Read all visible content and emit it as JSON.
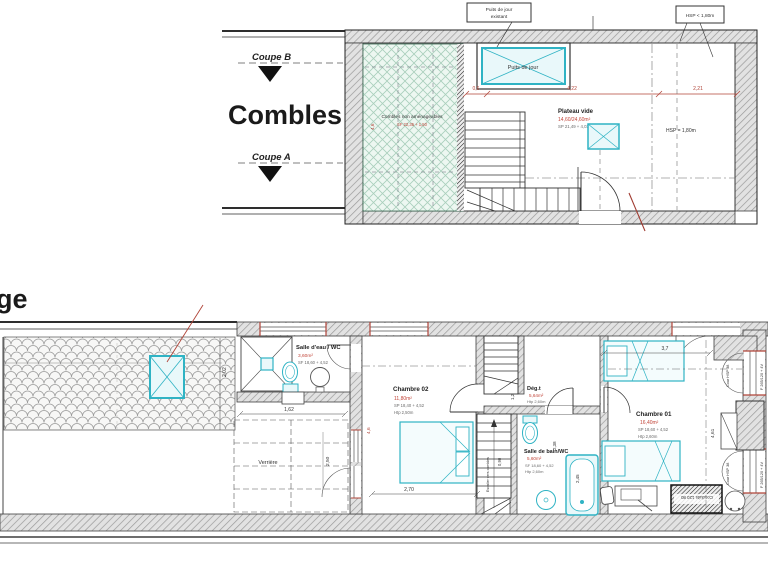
{
  "attic": {
    "title": "Combles",
    "coupe_b": "Coupe B",
    "coupe_a": "Coupe A",
    "unfinished_name": "Combles non aménageables",
    "unfinished_sub": "SF 22,35 + 1,50",
    "skylight_tag_line1": "Puits de jour",
    "skylight_tag_line2": "existant",
    "skylight_name": "Puits de jour",
    "hsp_tag": "HSP < 1,80m",
    "plateau_name": "Plateau vide",
    "plateau_area": "14,60/24,60m²",
    "plateau_sub": "SP 21,49 + 4,03",
    "hsp_mid": "HSP = 1,80m",
    "dim_a": "0,6",
    "dim_b": "4,22",
    "dim_c": "2,21",
    "dim_d": "4,6"
  },
  "floor": {
    "title_partial": "ge",
    "dim_roof": "2,02",
    "salle_eau_name": "Salle d'eau / WC",
    "salle_eau_area": "3,60m²",
    "salle_eau_sub": "SF 18,60 + 4,52",
    "dim_162": "1,62",
    "verriere": "Verrière",
    "dim_250": "2,50",
    "chambre02_name": "Chambre 02",
    "chambre02_area": "11,80m²",
    "chambre02_sub1": "SP 18,40 + 4,52",
    "chambre02_sub2": "Htp 2,50m",
    "dim_270": "2,70",
    "dim_46": "4,6",
    "stair_label": "Escalier vers combles",
    "stair_width": "0,90",
    "deg_name": "Dég.t",
    "deg_area": "5,64m²",
    "deg_sub": "Htp 2,60m",
    "dim_12": "1,2",
    "dim_238": "2,38",
    "sdb_name": "Salle de bain/WC",
    "sdb_area": "5,60m²",
    "sdb_sub1": "SF 18,60 + 4,52",
    "sdb_sub2": "Htp 2,60m",
    "dim_245": "2,45",
    "chambre01_name": "Chambre 01",
    "chambre01_area": "16,40m²",
    "chambre01_sub1": "SP 18,60 + 4,52",
    "chambre01_sub2": "Htp 2,60m",
    "dim_37": "3,7",
    "dim_461": "4,61",
    "window_court_1": "Cour HSP 38",
    "window_ref_1": "F 265/120 + 4V",
    "window_court_2": "Cour HSP 38",
    "window_ref_2": "F 265/120 + 4V",
    "conduits": "Conduits 120 80"
  }
}
